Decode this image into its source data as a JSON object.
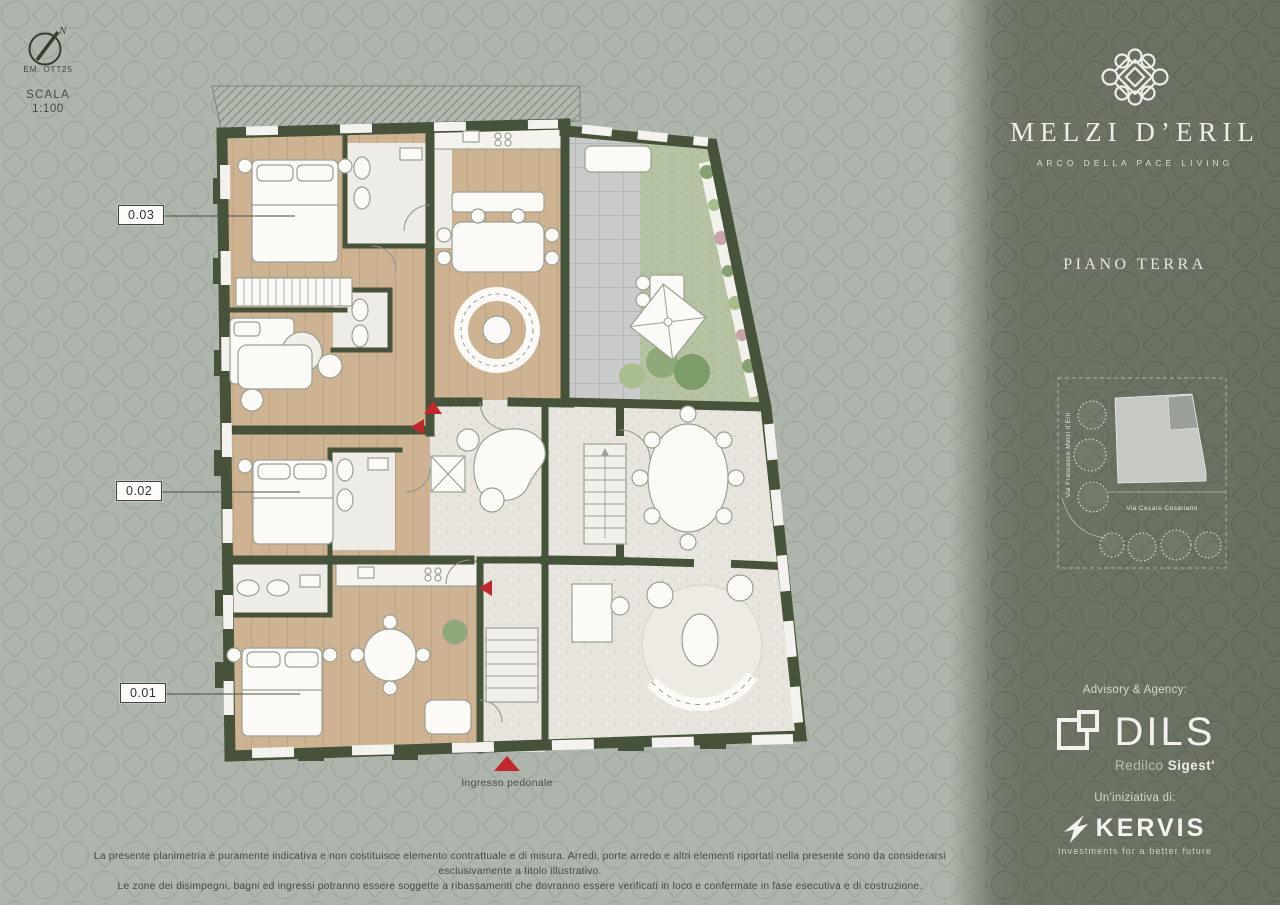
{
  "compass": {
    "north": "N",
    "emission": "EM. OTT25",
    "scale_label": "SCALA",
    "scale_value": "1:100"
  },
  "plan": {
    "unit_labels": [
      {
        "id": "0.03"
      },
      {
        "id": "0.02"
      },
      {
        "id": "0.01"
      }
    ],
    "entrance_label": "Ingresso pedonale"
  },
  "brand": {
    "name": "MELZI D’ERIL",
    "tagline": "ARCO DELLA PACE LIVING",
    "floor_title": "PIANO TERRA"
  },
  "site_map": {
    "street_vertical": "Via Francesco Melzi d’Eril",
    "street_horizontal": "Via Cesare Cesariano"
  },
  "partners": {
    "advisory_label": "Advisory & Agency:",
    "advisory_name": "DILS",
    "advisory_sub_light": "Redilco",
    "advisory_sub_bold": "Sigest'",
    "initiative_label": "Un'iniziativa di:",
    "initiative_name": "KERVIS",
    "initiative_tagline": "Investments for a better future"
  },
  "disclaimer": {
    "line1": "La presente planimetria è puramente indicativa e non costituisce elemento contrattuale e di misura. Arredi, porte arredo e altri elementi riportati nella presente sono da considerarsi esclusivamente a titolo illustrativo.",
    "line2": "Le zone dei disimpegni, bagni ed ingressi potranno essere soggette a ribassamenti che dovranno essere verificati in loco e confermate in fase esecutiva e di costruzione."
  },
  "colors": {
    "background": "#aeb5ac",
    "panel": "#6d7466",
    "wall": "#46523a",
    "wood": "#cdb392",
    "terrazzo": "#e7e5dd",
    "paver": "#c9cbca",
    "grass": "#b6c3a2",
    "accent_red": "#c1272d"
  }
}
